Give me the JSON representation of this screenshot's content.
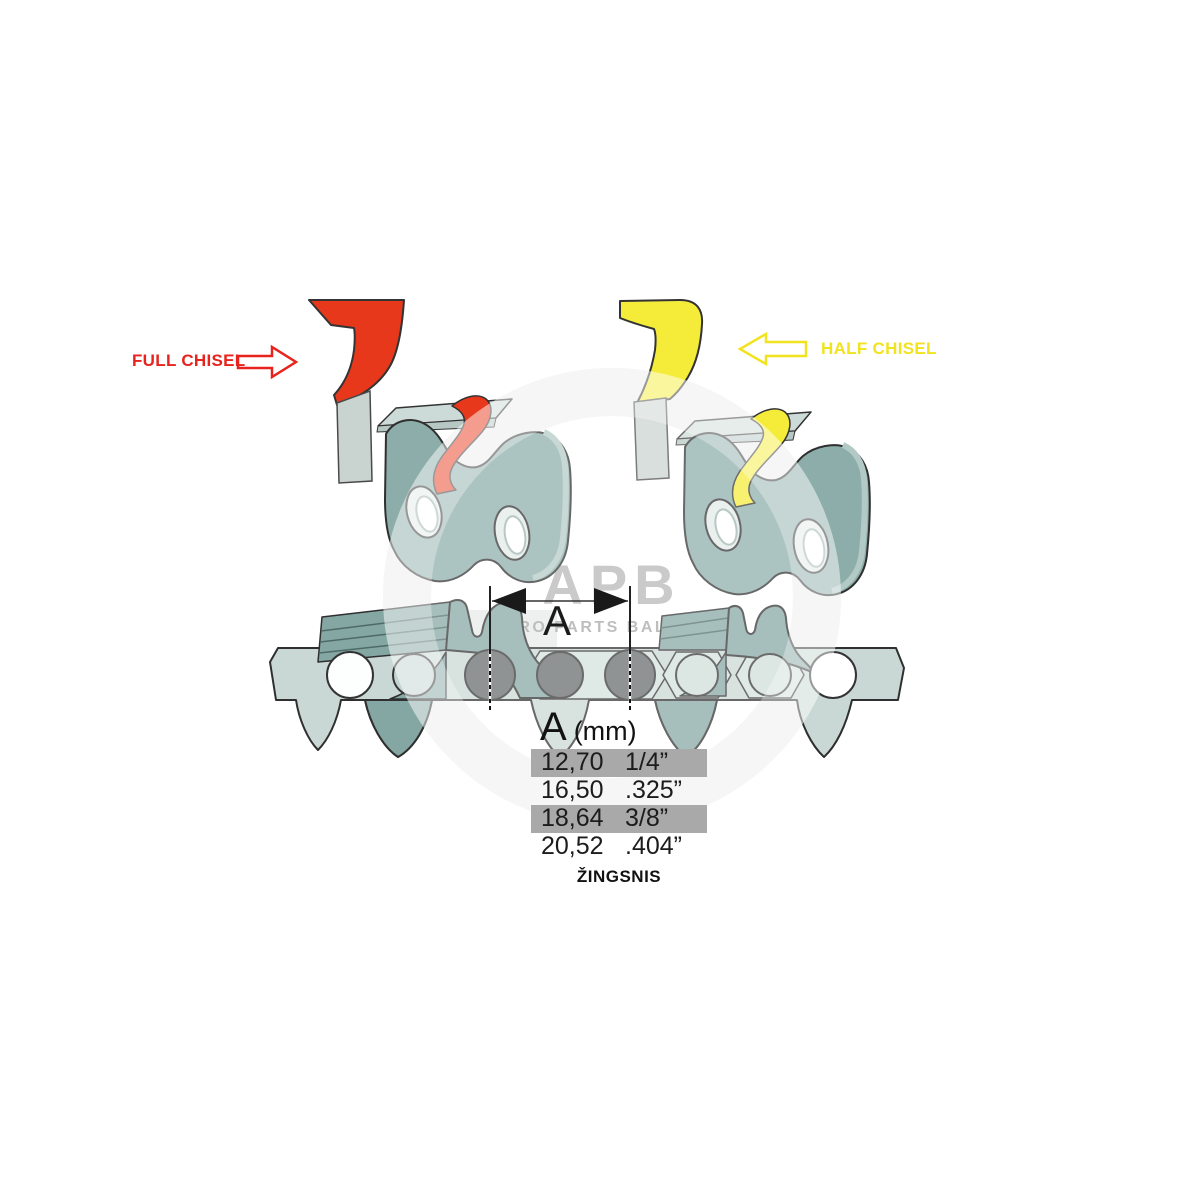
{
  "watermark": {
    "logo": "APB",
    "subtitle": "AGRO PARTS BALTIJA"
  },
  "labels": {
    "full_chisel": "FULL CHISEL",
    "half_chisel": "HALF CHISEL"
  },
  "dimension": {
    "letter": "A"
  },
  "pitch": {
    "header_letter": "A",
    "header_unit": "(mm)",
    "rows": [
      {
        "mm": "12,70",
        "inch": "1/4”",
        "highlighted": true
      },
      {
        "mm": "16,50",
        "inch": ".325”",
        "highlighted": false
      },
      {
        "mm": "18,64",
        "inch": "3/8”",
        "highlighted": true
      },
      {
        "mm": "20,52",
        "inch": ".404”",
        "highlighted": false
      }
    ],
    "caption": "ŽINGSNIS"
  },
  "colors": {
    "full_chisel_red": "#e8231d",
    "half_chisel_yellow": "#f1e31d",
    "link_body_teal": "#8cada9",
    "tooth_teal": "#84a7a3",
    "chain_band_light": "#c9d8d4",
    "rivet_dark": "#666a6b",
    "row_highlight_gray": "#a9a9a9",
    "watermark_gray": "#b6b6b6"
  }
}
